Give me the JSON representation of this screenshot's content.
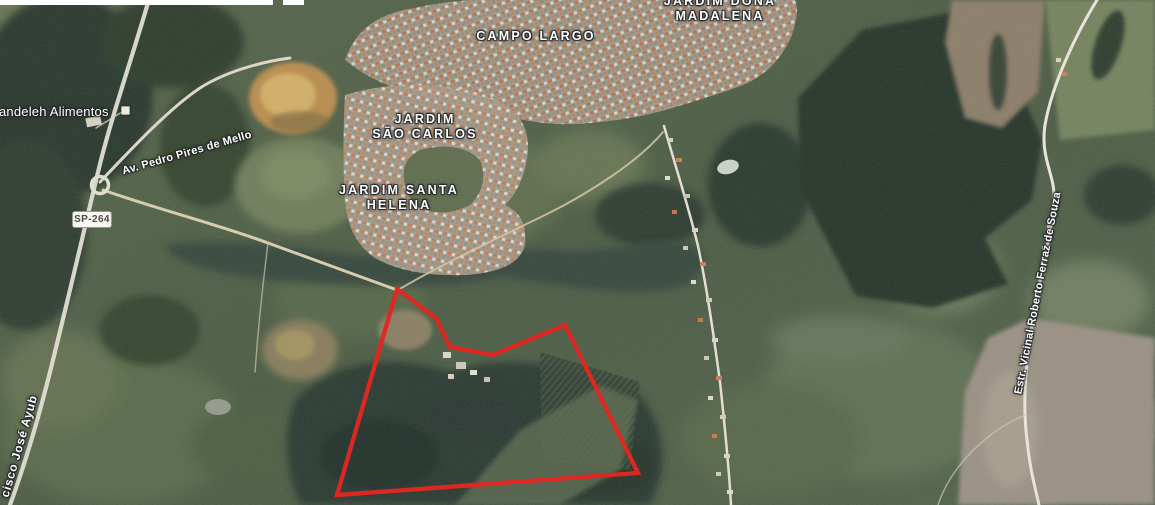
{
  "map": {
    "view": "satellite",
    "boundary_overlay": {
      "color": "#e22621",
      "shape": "property-polygon"
    },
    "labels": {
      "campo_largo": "CAMPO LARGO",
      "dona_madalena_line1": "JARDIM DONA",
      "dona_madalena_line2": "MADALENA",
      "sao_carlos_line1": "JARDIM",
      "sao_carlos_line2": "SÃO CARLOS",
      "santa_helena_line1": "JARDIM SANTA",
      "santa_helena_line2": "HELENA",
      "poi_kandeleh": "andeleh Alimentos",
      "road_av_pedro": "Av. Pedro Pires de Mello",
      "road_francisco_ayub": "cisco José Ayub",
      "road_estr_vicinal": "Estr. Vicinal Roberto Ferraz de Souza",
      "badge_sp264": "SP-264"
    }
  }
}
